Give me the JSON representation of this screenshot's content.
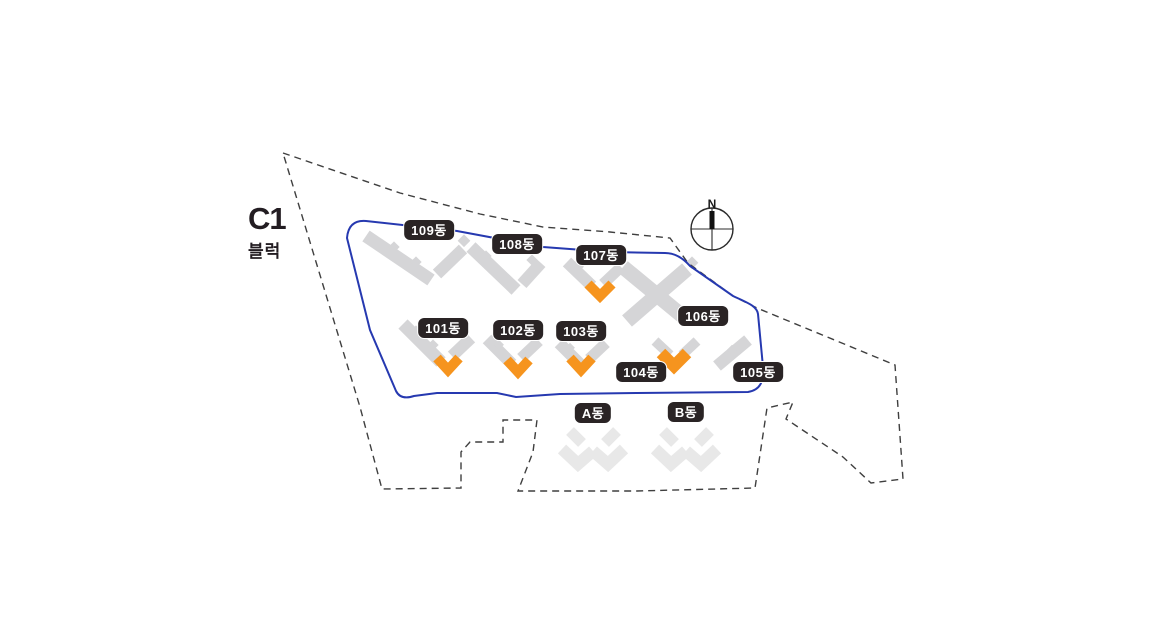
{
  "block": {
    "code": "C1",
    "label": "블럭"
  },
  "compass": {
    "north_label": "N"
  },
  "colors": {
    "block_boundary_blue": "#2639b0",
    "site_boundary_dash": "#3f3f3f",
    "building_gray": "#d5d5d7",
    "sub_building_gray": "#e8e8e8",
    "marker_orange": "#f6941e",
    "badge_bg": "#2a2425",
    "badge_text": "#ffffff",
    "title_text": "#231d22"
  },
  "buildings": {
    "b101": {
      "label": "101동",
      "marked": true
    },
    "b102": {
      "label": "102동",
      "marked": true
    },
    "b103": {
      "label": "103동",
      "marked": true
    },
    "b104": {
      "label": "104동",
      "marked": true
    },
    "b105": {
      "label": "105동",
      "marked": false
    },
    "b106": {
      "label": "106동",
      "marked": false
    },
    "b107": {
      "label": "107동",
      "marked": true
    },
    "b108": {
      "label": "108동",
      "marked": false
    },
    "b109": {
      "label": "109동",
      "marked": false
    },
    "bA": {
      "label": "A동",
      "marked": false
    },
    "bB": {
      "label": "B동",
      "marked": false
    }
  }
}
